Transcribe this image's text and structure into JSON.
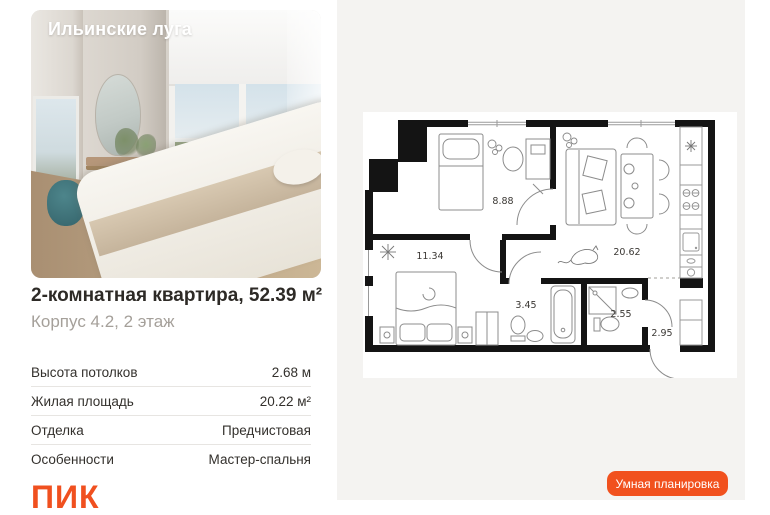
{
  "photo": {
    "overlay_title": "Ильинские луга"
  },
  "listing": {
    "title": "2-комнатная квартира, 52.39 м²",
    "subtitle": "Корпус 4.2, 2 этаж"
  },
  "specs": {
    "rows": [
      {
        "label": "Высота потолков",
        "value": "2.68 м"
      },
      {
        "label": "Жилая площадь",
        "value": "20.22 м²"
      },
      {
        "label": "Отделка",
        "value": "Предчистовая"
      },
      {
        "label": "Особенности",
        "value": "Мастер-спальня"
      }
    ]
  },
  "brand": {
    "logo_text": "ПИК"
  },
  "floorplan": {
    "rooms": [
      {
        "name": "bedroom",
        "area": "8.88"
      },
      {
        "name": "living-kitchen",
        "area": "20.62"
      },
      {
        "name": "master-bedroom",
        "area": "11.34"
      },
      {
        "name": "bathroom",
        "area": "3.45"
      },
      {
        "name": "shower-room",
        "area": "2.55"
      },
      {
        "name": "hallway",
        "area": "2.95"
      }
    ]
  },
  "actions": {
    "smart_plan_button": "Умная планировка"
  },
  "colors": {
    "accent": "#F1511E",
    "panel": "#F4F3F1",
    "title_text": "#2D2A26",
    "subtitle_text": "#A5A09A",
    "divider": "#E7E5E2",
    "wall": "#141414"
  }
}
